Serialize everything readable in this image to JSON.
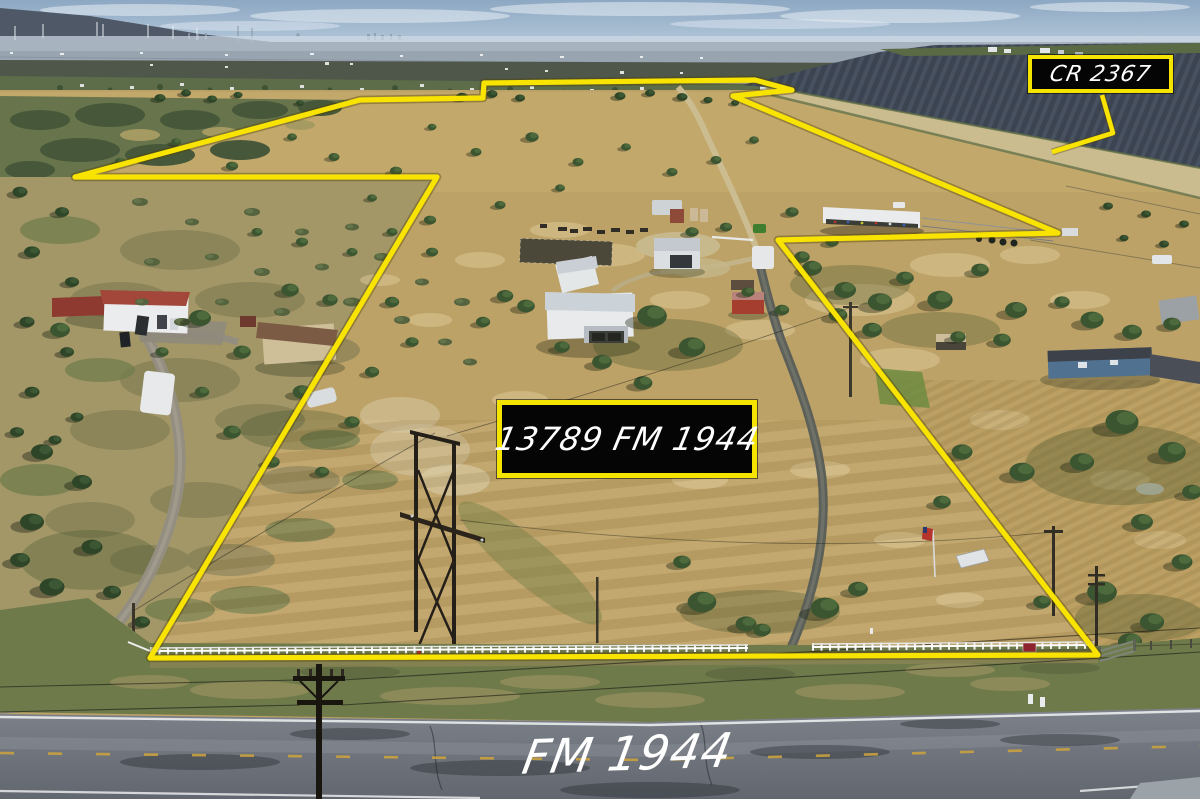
{
  "labels": {
    "cross_road": "CR 2367",
    "property_address": "13789 FM 1944",
    "front_road": "FM 1944"
  },
  "annotation": {
    "boundary_color": "#f8e400",
    "sign_background": "#050505",
    "sign_border_color": "#f5e400",
    "sign_text_color": "#ffffff",
    "boundary_points": "75,177 360,100 483,98 484,83 755,80 792,90 733,96 1058,233 778,240 1098,655 150,658 437,177",
    "callout_points": "1102,95 1113,133 1052,152"
  }
}
